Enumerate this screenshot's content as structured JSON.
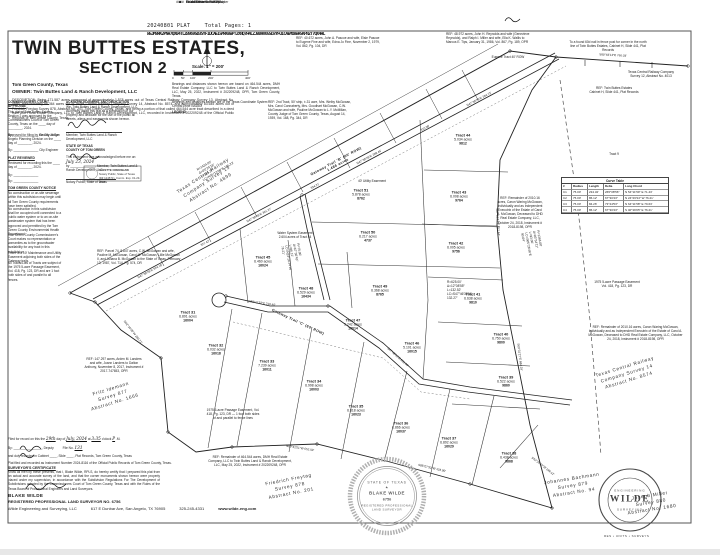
{
  "colors": {
    "ink": "#1d1d1d",
    "paper": "#ffffff",
    "seal_gray": "#8a8a8a"
  },
  "header": {
    "file_label": "20240801 PLAT",
    "pages_label": "Total Pages: 1",
    "barcode": "W5JM8RK2PNH7QX04TLZB96VGD3SYF1UCAEI5MRK8WPT2XNQ7H4LZJB09V6GSD3YFU1CAEMO8WR5KPN2T7QX4HL"
  },
  "title_block": {
    "title_line1": "TWIN BUTTES ESTATES,",
    "title_line2": "SECTION 2",
    "county": "Tom Green County, Texas",
    "owner": "OWNER: Twin Buttes Land & Ranch Development, LLC",
    "description": "DESCRIPTION: Being 171.587 acres composed of approximately 1.578 acres out of Texas Central Railway Company Survey 13, Abstract No. 4899, approximately 86.364 acres out of Texas Central Railway Company Survey 14, Abstract No. 8574, and approximately 83.645 acres out of Friedrich Freytag Survey 878, Abstract No. 201, Tom Green County, Texas, and being a portion of that called 464.544 acre tract described in a deed from DMH Real Estate Company, LLC to Twin Buttes Land & Ranch Development, LLC, recorded in Instrument # 202209248 of the Official Public Records of Tom Green County, Texas."
  },
  "scale": {
    "label": "Scale: 1″ = 200′",
    "ticks": [
      {
        "x": 172,
        "label": "0"
      },
      {
        "x": 181,
        "label": "50′"
      },
      {
        "x": 190,
        "label": "100′"
      },
      {
        "x": 208,
        "label": "200′"
      },
      {
        "x": 245,
        "label": "400′"
      }
    ],
    "basis_1": "Bearings and distances shown hereon are based on 464.544 acres, DMH Real Estate Company, LLC to Twin Buttes Land & Ranch Development, LLC, May 25, 2022, Instrument # 202209248, OPR, Tom Green County, Texas.",
    "basis_2": "Bearings and distances hereon are of the Texas Coordinate System Central Zone NAD83",
    "legend_title": "LEGEND",
    "legend_items": [
      {
        "symbol": "+",
        "label": "Found 1/2″ Iron Rod w/Cap"
      },
      {
        "symbol": "▲",
        "label": "Found Fence Corner Post"
      },
      {
        "symbol": "■",
        "label": "Found Concrete ROW Marker"
      },
      {
        "symbol": "●",
        "label": "Set 5/8″ Iron Rod w/Cap"
      },
      {
        "symbol": "####",
        "label": "911 Address"
      }
    ]
  },
  "left_column": {
    "blocks": [
      {
        "x": 8,
        "y": 100,
        "w": 54,
        "title": "COMMISSIONERS COURT APPROVAL",
        "body": "This plat of Twin Buttes Estates, Section 2 was approved by the Commissioners Court of Tom Green County, Texas on the ____ day of ________, 2024.",
        "sig": "By: ______________  County Judge"
      },
      {
        "x": 8,
        "y": 132,
        "w": 54,
        "title": "",
        "body": "Approved for filing by the City of San Angelo Planning Division on the ____ day of ________, 2024.",
        "sig": "By: ______________  City Engineer"
      },
      {
        "x": 8,
        "y": 156,
        "w": 54,
        "title": "PLAT REVIEWED",
        "body": "Reviewed for recording this the ____ day of ________, 2024.",
        "sig": "By: ______________\nBy: ______________"
      },
      {
        "x": 8,
        "y": 186,
        "w": 54,
        "title": "TOM GREEN COUNTY NOTICE",
        "body": "No construction or on-site sewerage within this subdivision may begin until all Tom Green County requirements have been satisfied.",
        "sig": ""
      },
      {
        "x": 8,
        "y": 206,
        "w": 54,
        "title": "",
        "body": "No construction in this subdivision shall be occupied until connected to a public water system or to an on-site wastewater system that has been approved and permitted by the Tom Green County Environmental Health Department.",
        "sig": ""
      },
      {
        "x": 8,
        "y": 232,
        "w": 54,
        "title": "",
        "body": "Tom Green County Commissioner's Court makes no representation or warranties as to the groundwater availability for any tract in this subdivision.",
        "sig": ""
      },
      {
        "x": 8,
        "y": 250,
        "w": 54,
        "title": "",
        "body": "There is a 10′ Maintenance and Utility Easement adjoining both sides of the Gateway trails.",
        "sig": ""
      },
      {
        "x": 8,
        "y": 260,
        "w": 54,
        "title": "",
        "body": "All Tracts/Lots of Tracts are subject of the 1975 5-acre Passage Easement, Vol. 418, Pg. 123, DR and are 1 foot both sides of and parallel to all fences.",
        "sig": ""
      }
    ]
  },
  "dedication": {
    "title": "ACKNOWLEDGMENT AND DEDICATION",
    "body": "We, Twin Buttes Land & Ranch Development, LLC, do hereby adopt this plat as a subdivision of our property and dedicate for the use of the public all streets, alleys and easements shown hereon.",
    "name_line": "Member, Twin Buttes Land & Ranch Development, LLC",
    "state_line": "STATE OF TEXAS",
    "county_line": "COUNTY OF TOM GREEN",
    "ack_text": "This instrument was acknowledged before me on:",
    "ack_date": "July 23, 2024",
    "ack_by": "by ______________, Member, Twin Buttes Land & Ranch Development, LLC.",
    "notary_line": "Notary Public, State of Texas",
    "stamp_name": "SUZETTE CRENSHAW",
    "stamp_l2": "Notary Public, State of Texas",
    "stamp_l3": "ID# 124573 • Comm. Exp. 01-23-2025"
  },
  "clerk": {
    "l1_pre": "Filed for record on this the",
    "date": "29th",
    "l1_mid": "day of",
    "month": "July, 2024",
    "l1_at": "at",
    "time": "3:35",
    "l1_oclock": "o'clock",
    "meridian": "P",
    "l1_m": ".M.",
    "l2": "By: ________________, Deputy",
    "file_label": "File No.",
    "file_no": "131",
    "l3": "and duly recorded in Cabinet ____, Slide ____, Plat Records, Tom Green County, Texas",
    "l4": "Plat filed and recorded as Instrument Number 2024-8116 of the Official Public Records of Tom Green County, Texas."
  },
  "certificate": {
    "title": "SURVEYOR'S CERTIFICATE",
    "body": "Know all men by these presents, that I, Blake Wilde, RPLS, do hereby certify that I prepared this plat from an actual and accurate survey of the land, and that the corner monuments shown hereon were properly placed under my supervision, in accordance with the Subdivision Regulations For The Development of Subdivisions adopted by the Commissioners Court of Tom Green County, Texas and with the Rules of the Texas Board of Professional Engineers and Land Surveyors."
  },
  "footer": {
    "name": "BLAKE WILDE",
    "reg_line": "REGISTERED PROFESSIONAL LAND SURVEYOR NO. 6756",
    "firm": "Wilde Engineering and Surveying, LLC",
    "address": "617 E Dunbar Ave, San Angelo, TX 76905",
    "phone": "325-245-4331",
    "web": "www.wilde-eng.com"
  },
  "stamps": {
    "seal_state": "STATE OF TEXAS",
    "seal_star": "★",
    "seal_name": "BLAKE WILDE",
    "seal_no": "6756",
    "seal_l4": "REGISTERED PROFESSIONAL",
    "seal_l5": "LAND SURVEYOR",
    "logo_top": "ENGINEERING",
    "logo_text": "WILDE",
    "logo_bottom": "SURVEYING",
    "logo_sub": "RES • UNITS • SURVEYS"
  },
  "plat": {
    "surveys": [
      {
        "x": 207,
        "y": 182,
        "rot": -33,
        "name": "Texas Central Railway\nCompany Survey 13\nAbstract No. 4899"
      },
      {
        "x": 627,
        "y": 374,
        "rot": -17,
        "name": "Texas Central Railway\nCompany Survey 14\nAbstract No. 8574"
      },
      {
        "x": 113,
        "y": 396,
        "rot": -17,
        "name": "Fritz Idemann\nSurvey 877\nAbstract No. 1666"
      },
      {
        "x": 290,
        "y": 487,
        "rot": -11,
        "name": "Friedrich Freytag\nSurvey 878\nAbstract No. 201"
      },
      {
        "x": 573,
        "y": 486,
        "rot": -9,
        "name": "Johannes Bachmann\nSurvey 879\nAbstract No. 94"
      },
      {
        "x": 651,
        "y": 503,
        "rot": -9,
        "name": "Joseph Miller\nSurvey 880\nAbstract No. 1680"
      }
    ],
    "roads": [
      {
        "x": 337,
        "y": 163,
        "rot": -28,
        "label": "Gateway Trail 'B' (60′ ROW)\n1.486 acres"
      },
      {
        "x": 298,
        "y": 322,
        "rot": 25,
        "label": "Gateway Trail 'C' (60′ ROW)"
      }
    ],
    "tracts": [
      {
        "x": 361,
        "y": 194,
        "name": "Tract 51",
        "acres": "5.878 acres",
        "address": "8762"
      },
      {
        "x": 368,
        "y": 236,
        "name": "Tract 50",
        "acres": "6.217 acres",
        "address": "4737"
      },
      {
        "x": 380,
        "y": 290,
        "name": "Tract 49",
        "acres": "6.368 acres",
        "address": "8765"
      },
      {
        "x": 306,
        "y": 292,
        "name": "Tract 48",
        "acres": "6.529 acres",
        "address": "16434"
      },
      {
        "x": 263,
        "y": 261,
        "name": "Tract 45",
        "acres": "6.460 acres",
        "address": "16024"
      },
      {
        "x": 353,
        "y": 324,
        "name": "Tract 47",
        "acres": "5.242 acres",
        "address": "16014"
      },
      {
        "x": 412,
        "y": 347,
        "name": "Tract 46",
        "acres": "5.101 acres",
        "address": "16015"
      },
      {
        "x": 463,
        "y": 139,
        "name": "Tract 44",
        "acres": "5.034 acres",
        "address": "9812"
      },
      {
        "x": 459,
        "y": 196,
        "name": "Tract 43",
        "acres": "6.008 acres",
        "address": "9764"
      },
      {
        "x": 456,
        "y": 247,
        "name": "Tract 42",
        "acres": "6.005 acres",
        "address": "9756"
      },
      {
        "x": 473,
        "y": 298,
        "name": "Tract 41",
        "acres": "6.638 acres",
        "address": "9810"
      },
      {
        "x": 501,
        "y": 338,
        "name": "Tract 40",
        "acres": "6.750 acres",
        "address": "9800"
      },
      {
        "x": 506,
        "y": 381,
        "name": "Tract 39",
        "acres": "6.522 acres",
        "address": "9860"
      },
      {
        "x": 509,
        "y": 457,
        "name": "Tract 38",
        "acres": "6.438 acres",
        "address": "9868"
      },
      {
        "x": 449,
        "y": 442,
        "name": "Tract 37",
        "acres": "6.892 acres",
        "address": "16029"
      },
      {
        "x": 401,
        "y": 427,
        "name": "Tract 36",
        "acres": "6.866 acres",
        "address": "16037"
      },
      {
        "x": 356,
        "y": 410,
        "name": "Tract 35",
        "acres": "6.818 acres",
        "address": "16023"
      },
      {
        "x": 314,
        "y": 385,
        "name": "Tract 34",
        "acres": "6.998 acres",
        "address": "16003"
      },
      {
        "x": 267,
        "y": 365,
        "name": "Tract 33",
        "acres": "7.239 acres",
        "address": "16011"
      },
      {
        "x": 216,
        "y": 349,
        "name": "Tract 32",
        "acres": "6.032 acres",
        "address": "16018"
      },
      {
        "x": 188,
        "y": 316,
        "name": "Tract 31",
        "acres": "6.891 acres",
        "address": "16004"
      }
    ],
    "notes": [
      {
        "x": 296,
        "y": 36,
        "w": 86,
        "t": "REF: 40.672 acres, John A. Pascoe and wife, Elsie Pascoe to Eugene Fine and wife, Edna Jo Fine, November 2, 1979, Vol. 862, Pg. 104, DR"
      },
      {
        "x": 446,
        "y": 32,
        "w": 88,
        "t": "REF: 48.972 acres, John H. Reynolds and wife (Genevieve Reynolds), and Ralph I. Miller and wife, Ella K. Wallis to Marcus E. Tips, January 31, 1986, Vol. 867, Pg. 189, OPR"
      },
      {
        "x": 568,
        "y": 40,
        "w": 80,
        "ta": "center",
        "t": "To a found 60d nail in fence post for corner in the north line of Twin Buttes Estates, Cabinet H, Slide 441, Plat Records"
      },
      {
        "x": 612,
        "y": 70,
        "w": 78,
        "ta": "center",
        "t": "Texas Central Railway Company\nSurvey 12, Abstract No. 4013"
      },
      {
        "x": 486,
        "y": 55,
        "w": 44,
        "ta": "center",
        "t": "Eugene Tract 40′ ROW"
      },
      {
        "x": 268,
        "y": 100,
        "w": 84,
        "t": "REF: 2nd Tract, 50′ strip, ±.31 acre, Mrs. Welby McGowan, Mrs. Carol Connaberty, Mrs. Goodhart McGowan, C.W. McGowan and wife, Pauline McGowan to L.Y. McMillan, County Judge of Tom Green County, Texas, August 14, 1939, Vol. 168, Pg. 344, DR"
      },
      {
        "x": 583,
        "y": 86,
        "w": 62,
        "ta": "center",
        "t": "REF: Twin Buttes Estates\nCabinet H, Slide 441, Plat Records"
      },
      {
        "x": 600,
        "y": 152,
        "w": 28,
        "ta": "center",
        "t": "Tract 9"
      },
      {
        "x": 497,
        "y": 196,
        "w": 46,
        "ta": "center",
        "t": "REF: Remainder of 2010.16 acres, Caron Waring McGowan, Individually and as Independent Executrix of the Estate of Carol A. McGowan, Deceased to DHD Real Estate Company, LLC, October 24, 2018, Instrument # 2018-8198, OPR"
      },
      {
        "x": 585,
        "y": 280,
        "w": 64,
        "ta": "center",
        "t": "1975 5-acre Passage Easement\nVol. 418, Pg. 123, DR"
      },
      {
        "x": 588,
        "y": 325,
        "w": 95,
        "ta": "center",
        "t": "REF: Remainder of 2010.16 acres, Caron Waring McGowan, Individually and as Independent Executrix of the Estate of Carol A. McGowan, Deceased to DHD Real Estate Company, LLC, October 24, 2018, Instrument # 2018-8198, OPR"
      },
      {
        "x": 205,
        "y": 408,
        "w": 56,
        "ta": "center",
        "t": "1975 5-acre Passage Easement, Vol. 418, Pg. 123, DR — 1 foot both sides of and parallel to fence lines"
      },
      {
        "x": 206,
        "y": 455,
        "w": 88,
        "ta": "center",
        "t": "REF: Remainder of 464.544 acres, DMH Real Estate Company, LLC to Twin Buttes Land & Ranch Development, LLC, May 25, 2022, Instrument # 202209248, OPR"
      },
      {
        "x": 84,
        "y": 357,
        "w": 60,
        "ta": "center",
        "t": "REF: 147.297 acres, Arden M. Landers and wife, Joann Landers to Dalton Anthony, November 8, 2017, Instrument # 2017-747653, OPR"
      },
      {
        "x": 277,
        "y": 231,
        "w": 36,
        "ta": "center",
        "t": "Water System Easement\n2.604 acres of Tract 44"
      },
      {
        "x": 355,
        "y": 179,
        "w": 34,
        "ta": "center",
        "t": "40′ Utility Easement"
      },
      {
        "x": 97,
        "y": 249,
        "w": 84,
        "t": "REF: Parcel 74, 8.847 acres, C.W. McGowan and wife, Pauline M. McGowan, Carol M. McGowan, Lillie McGowan II, and Juliana B. McGowan to the State of Texas, February 13, 1987, Vol. 714, Pg. 574, DR"
      },
      {
        "x": 196,
        "y": 168,
        "w": 36,
        "rot": -30,
        "t": "R=1434.00′\nΔ=05°24′18″\nL=135.27′\nLC=N45°12′08″E 135.22′"
      },
      {
        "x": 300,
        "y": 243,
        "w": 30,
        "rot": 80,
        "t": "R=75.00′\nΔ=67°30′43″\nL=86.12′\nLC=N24°26′34″W 76.21′"
      },
      {
        "x": 447,
        "y": 280,
        "w": 34,
        "t": "R=625.00′\nΔ=12°08′55″\nL=132.52′\nLC=S47°46′33″W 132.27′"
      },
      {
        "x": 540,
        "y": 230,
        "w": 32,
        "rot": 80,
        "t": "R=1366.00′\nΔ=03°54′11″\nL=93.06′\nLC=S05°28′46″E 93.04′"
      }
    ],
    "bearings": [
      {
        "x": 150,
        "y": 271,
        "rot": -28,
        "t": "N47°39′28″E  524.18′"
      },
      {
        "x": 205,
        "y": 243,
        "rot": -28,
        "t": "327.42′"
      },
      {
        "x": 259,
        "y": 215,
        "rot": -28,
        "t": "N47°39′28″E  301.27′"
      },
      {
        "x": 315,
        "y": 186,
        "rot": -28,
        "t": "334.21′"
      },
      {
        "x": 369,
        "y": 157,
        "rot": -28,
        "t": "N47°39′28″E  298.44′"
      },
      {
        "x": 425,
        "y": 128,
        "rot": -28,
        "t": "310.08′"
      },
      {
        "x": 479,
        "y": 99,
        "rot": -28,
        "t": "N47°39′28″E  264.73′"
      },
      {
        "x": 613,
        "y": 55,
        "rot": 3,
        "t": "S89°48′14″E  760.03′"
      },
      {
        "x": 498,
        "y": 222,
        "rot": 86,
        "t": "S07°12′41″E  512.44′"
      },
      {
        "x": 300,
        "y": 448,
        "rot": 9,
        "t": "N89°42′51″W  652.03′"
      },
      {
        "x": 432,
        "y": 468,
        "rot": 13,
        "t": "S85°07′33″W  423.90′"
      },
      {
        "x": 133,
        "y": 332,
        "rot": 52,
        "t": "N42°16′05″W  280.77′"
      },
      {
        "x": 543,
        "y": 466,
        "rot": 38,
        "t": "S52°24′10″W  198.12′"
      },
      {
        "x": 520,
        "y": 357,
        "rot": 83,
        "t": "S09°31′27″E  684.29′"
      },
      {
        "x": 398,
        "y": 357,
        "rot": 42,
        "t": "S47°48′10″E  530.55′"
      },
      {
        "x": 262,
        "y": 303,
        "rot": 8,
        "t": "N83°11′52″E  210.40′"
      }
    ],
    "curve_table": {
      "title": "Curve Table",
      "headers": [
        "#",
        "Radius",
        "Length",
        "Delta",
        "Long Chord"
      ],
      "rows": [
        [
          "C1",
          "75.00′",
          "234.32′",
          "265°08′56″",
          "N 54°11′59″ E  71.43′"
        ],
        [
          "C2",
          "75.00′",
          "86.12′",
          "67°30′43″",
          "N 24°26′34″ W  76.21′"
        ],
        [
          "C3",
          "75.00′",
          "84.26′",
          "73°44′53″",
          "N 64°11′58″ E  79.63′"
        ],
        [
          "C4",
          "75.00′",
          "86.12′",
          "67°30′43″",
          "S 40°39′05″ E  76.21′"
        ]
      ]
    }
  }
}
